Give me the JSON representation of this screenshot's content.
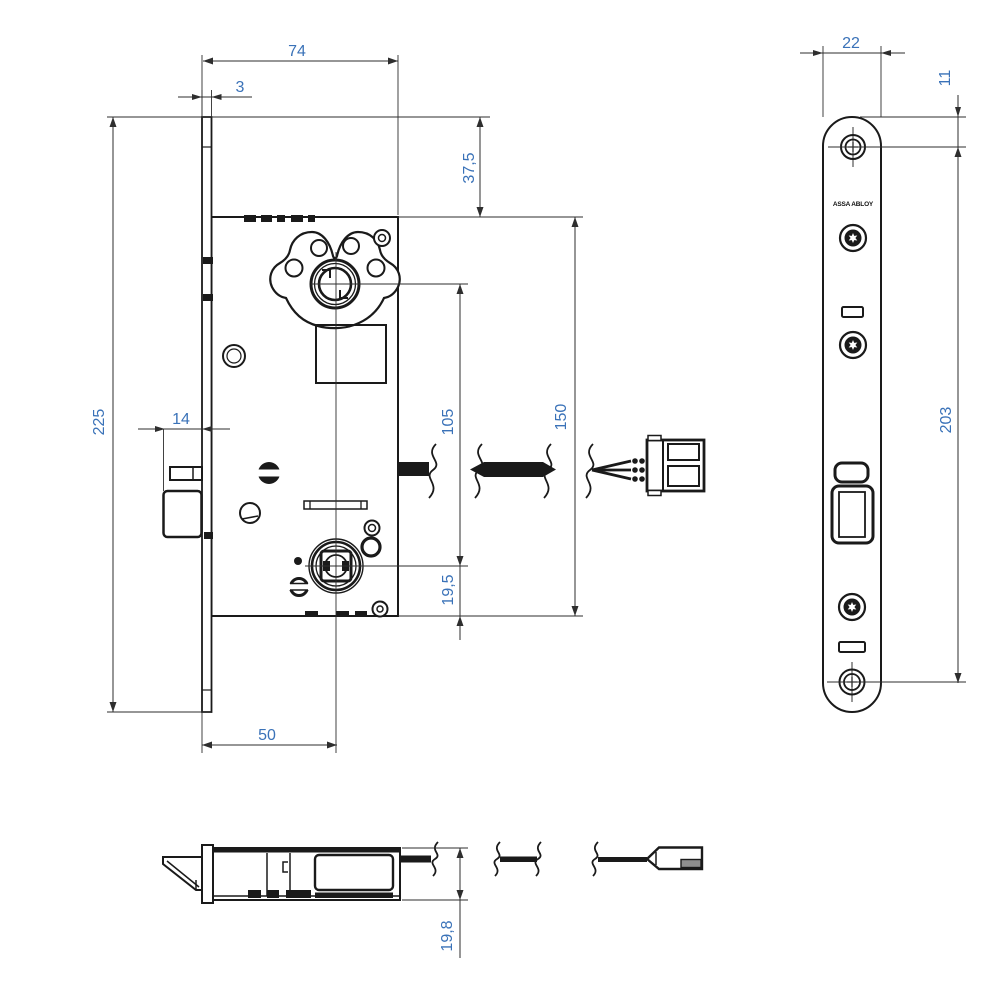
{
  "drawing": {
    "type": "technical-drawing",
    "subject": "mortise-lock-case-front-side-top-views",
    "logo_text": "ASSA ABLOY",
    "colors": {
      "line": "#1a1a1a",
      "dim_line": "#2e2e2e",
      "dim_text": "#3a72b8"
    },
    "dims": {
      "case_depth": "74",
      "faceplate_thickness": "3",
      "top_to_case_top": "37,5",
      "case_height": "150",
      "cylinder_to_follower": "105",
      "follower_to_case_bottom": "19,5",
      "latch_protrusion": "14",
      "faceplate_length": "225",
      "backset": "50",
      "faceplate_width": "22",
      "top_to_screw": "11",
      "screw_centers": "203",
      "case_thickness": "19,8"
    }
  }
}
